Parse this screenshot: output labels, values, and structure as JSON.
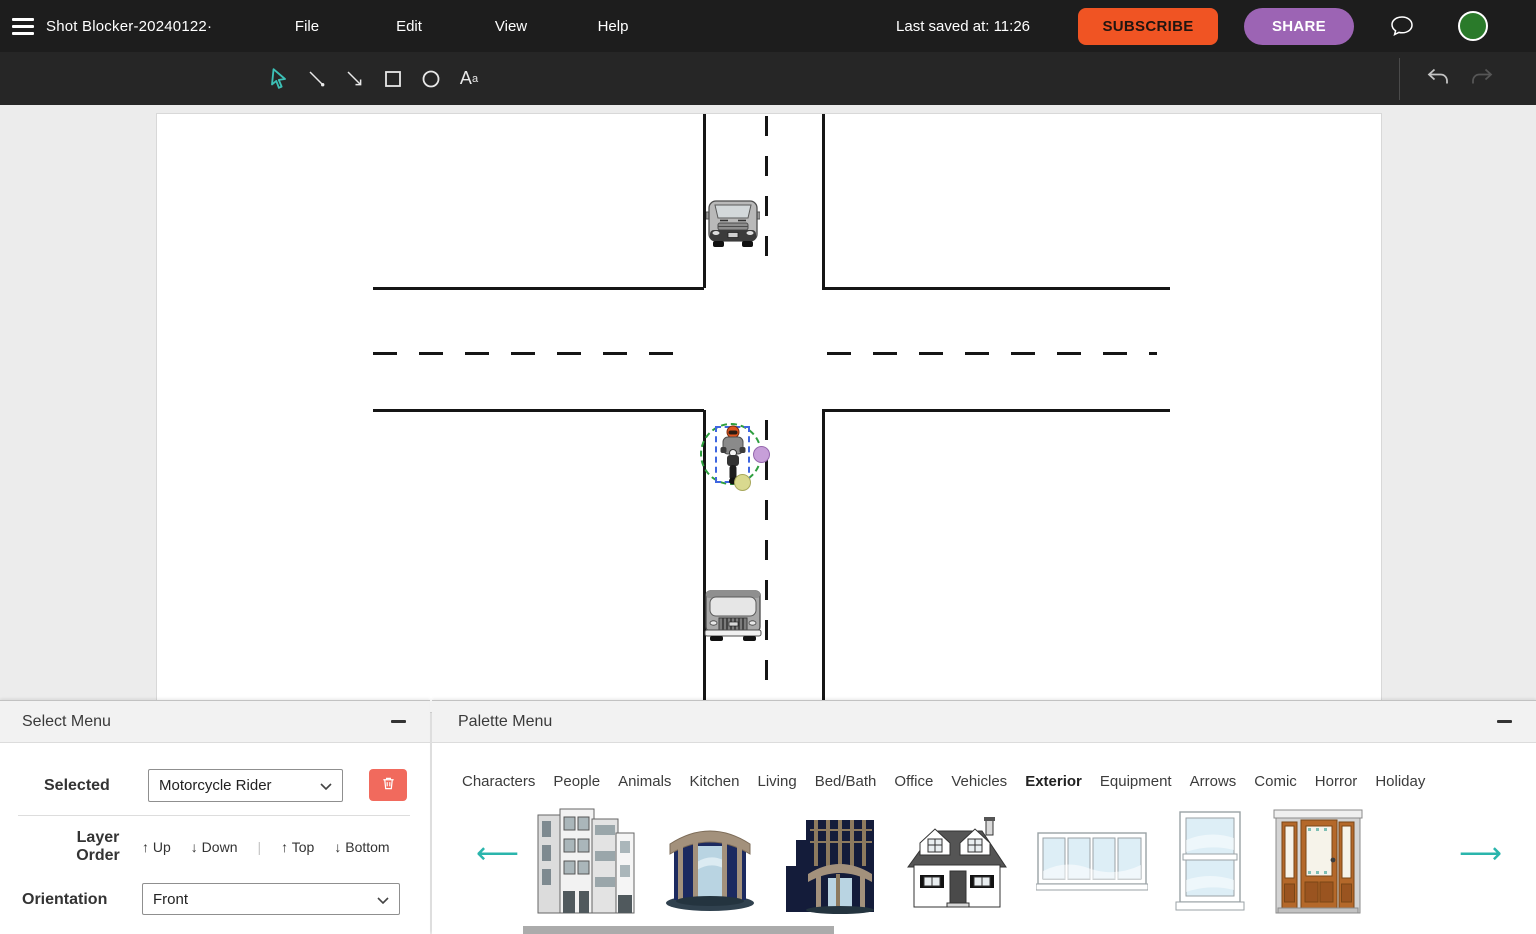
{
  "app": {
    "title": "Shot Blocker-20240122·",
    "menus": [
      "File",
      "Edit",
      "View",
      "Help"
    ],
    "last_saved": "Last saved at: 11:26",
    "subscribe_label": "SUBSCRIBE",
    "share_label": "SHARE"
  },
  "toolbar": {
    "tools": [
      "select",
      "line",
      "arrow",
      "rectangle",
      "ellipse",
      "text"
    ],
    "selected_tool": "select",
    "text_tool_glyph_main": "A",
    "text_tool_glyph_sup": "a"
  },
  "canvas": {
    "objects": [
      "van",
      "motorcycle-rider",
      "truck"
    ],
    "selected_object": "Motorcycle Rider"
  },
  "select_menu": {
    "title": "Select Menu",
    "selected_label": "Selected",
    "selected_value": "Motorcycle Rider",
    "layer_order_line1": "Layer",
    "layer_order_line2": "Order",
    "layer_up": "↑ Up",
    "layer_down": "↓ Down",
    "layer_divider": "|",
    "layer_top": "↑ Top",
    "layer_bottom": "↓ Bottom",
    "orientation_label": "Orientation",
    "orientation_value": "Front"
  },
  "palette_menu": {
    "title": "Palette Menu",
    "categories": [
      "Characters",
      "People",
      "Animals",
      "Kitchen",
      "Living",
      "Bed/Bath",
      "Office",
      "Vehicles",
      "Exterior",
      "Equipment",
      "Arrows",
      "Comic",
      "Horror",
      "Holiday"
    ],
    "active_category": "Exterior",
    "items": [
      "apartment-buildings",
      "round-entrance-building",
      "art-deco-building",
      "suburban-house",
      "wide-window",
      "double-hung-window",
      "front-door"
    ],
    "prev_arrow": "⟵",
    "next_arrow": "⟶"
  },
  "colors": {
    "subscribe_orange": "#f05423",
    "share_purple": "#9c64b4",
    "accent_teal": "#2ab5ac",
    "delete_red": "#f16a5d",
    "avatar_green": "#2a7a2a",
    "selection_blue": "#3f66e0",
    "selection_green": "#2e9e3e",
    "handle_purple": "#c79fd9",
    "handle_yellow": "#d9d98f"
  }
}
